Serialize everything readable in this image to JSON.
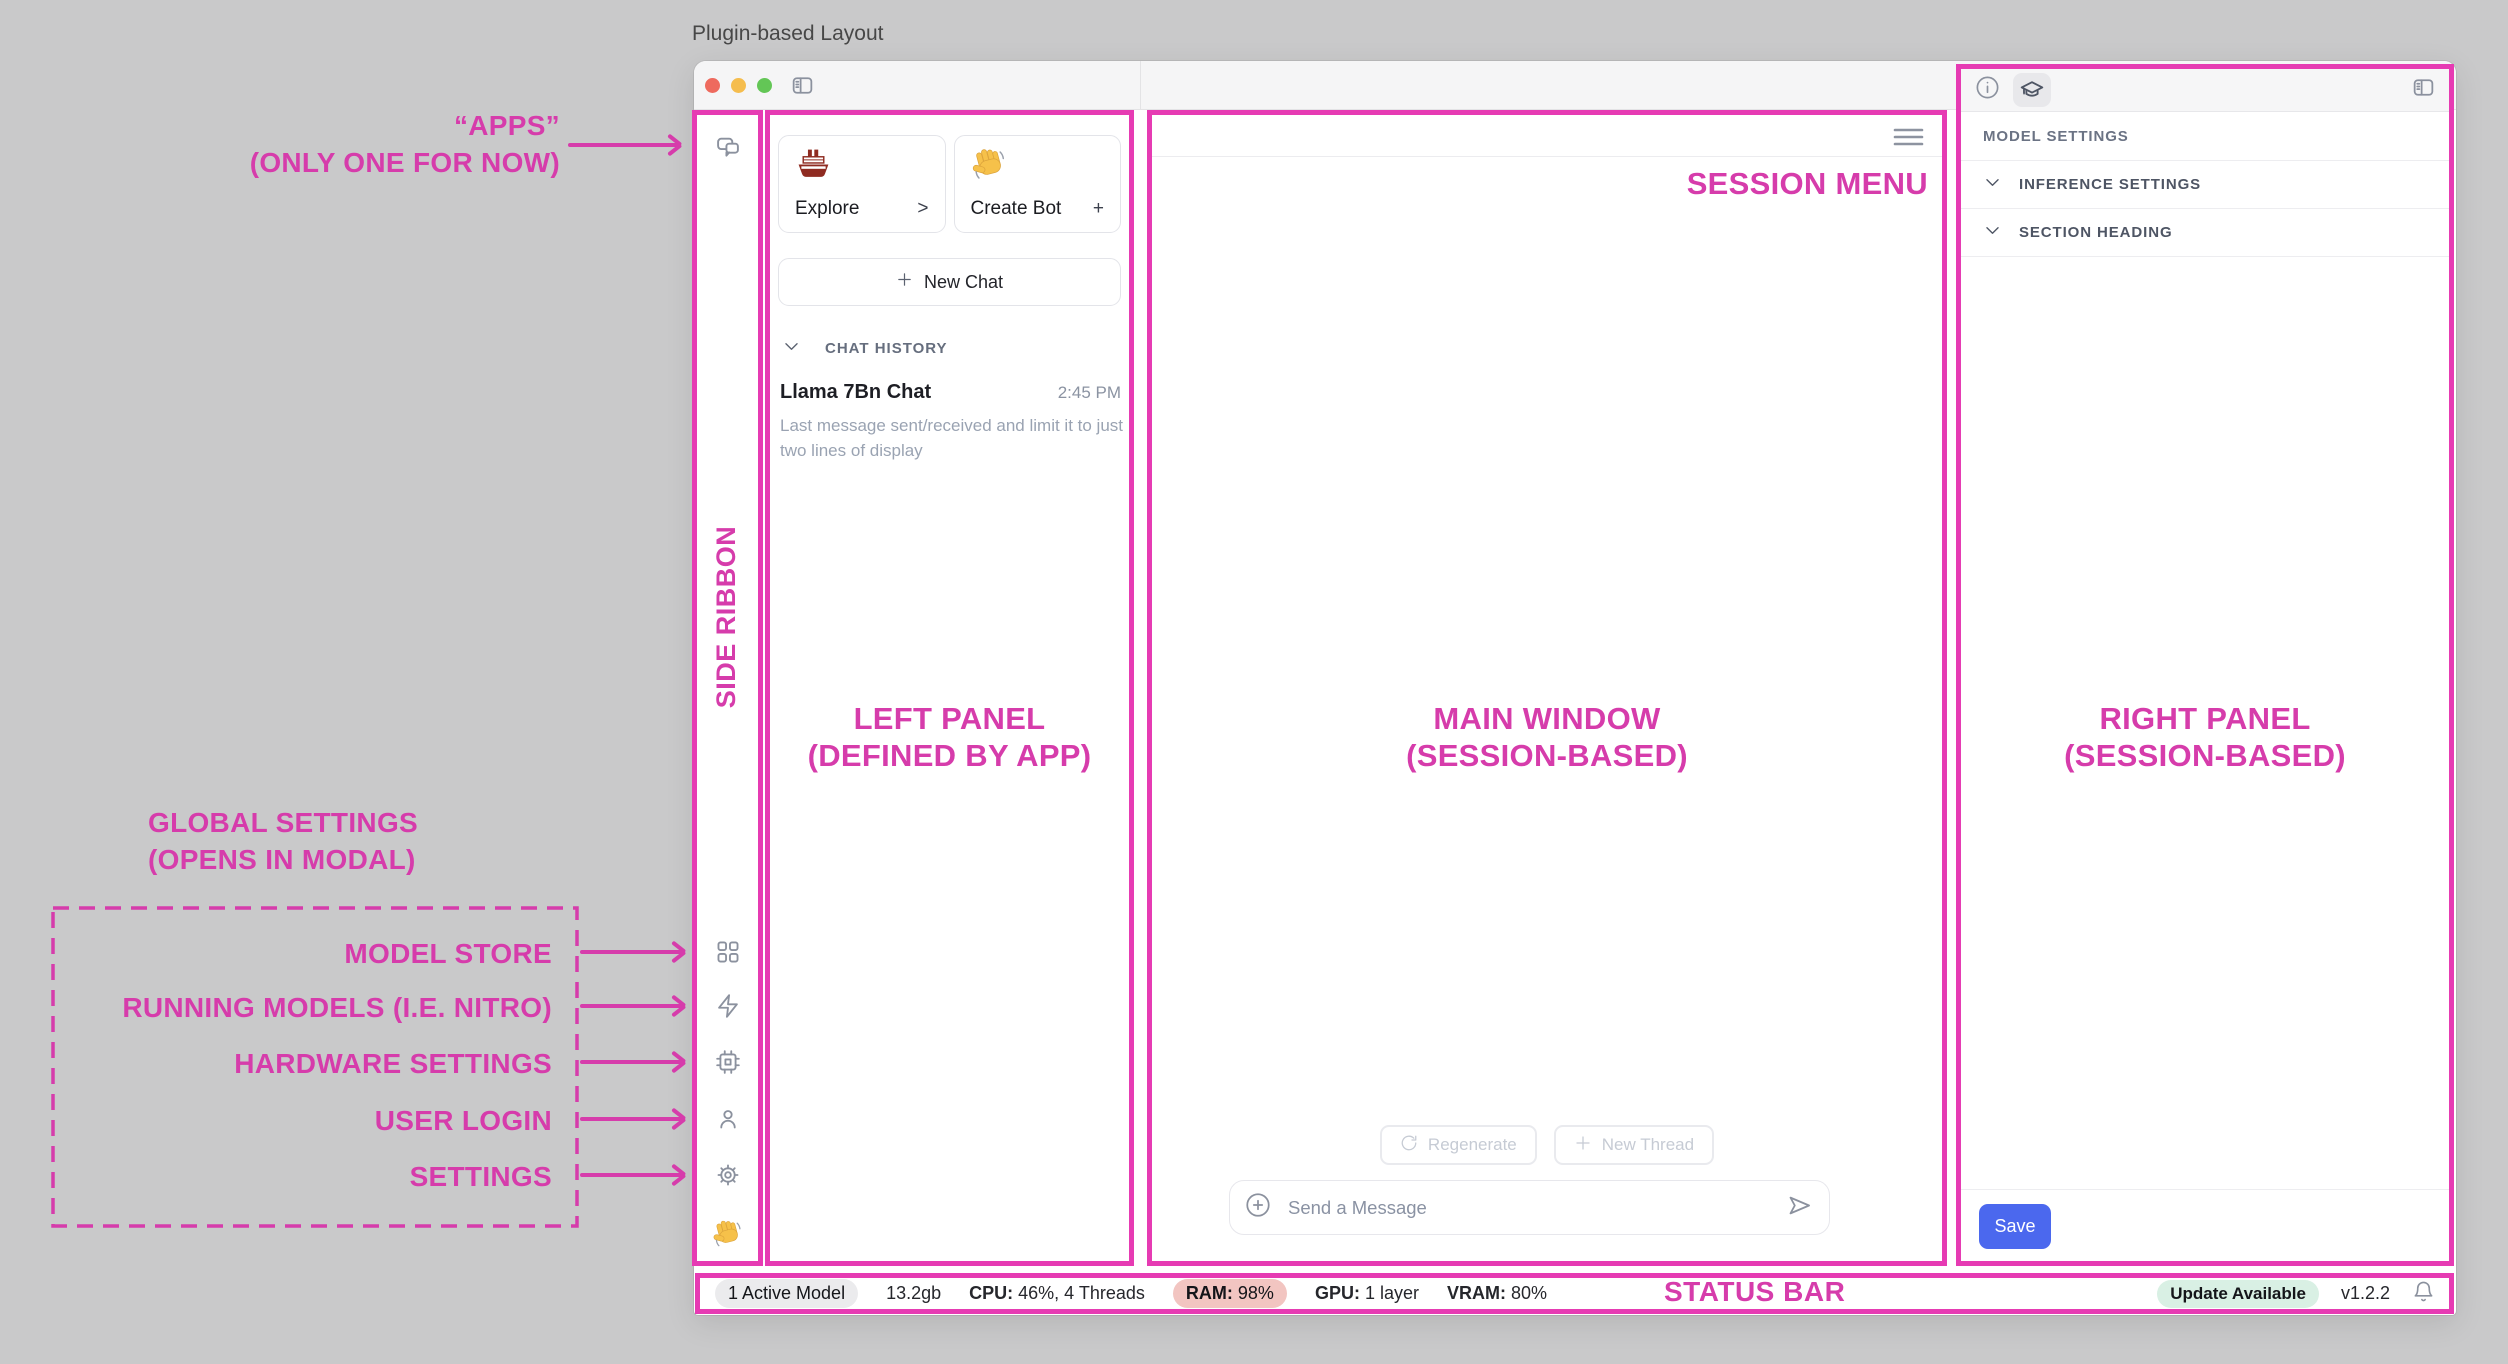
{
  "page": {
    "title": "Plugin-based Layout"
  },
  "annotations": {
    "apps_line1": "“APPS”",
    "apps_line2": "(ONLY ONE FOR NOW)",
    "side_ribbon": "SIDE RIBBON",
    "left_panel_line1": "LEFT PANEL",
    "left_panel_line2": "(DEFINED BY APP)",
    "main_window_line1": "MAIN WINDOW",
    "main_window_line2": "(SESSION-BASED)",
    "right_panel_line1": "RIGHT PANEL",
    "right_panel_line2": "(SESSION-BASED)",
    "session_menu": "SESSION MENU",
    "status_bar": "STATUS BAR",
    "global_settings_line1": "GLOBAL SETTINGS",
    "global_settings_line2": "(OPENS IN MODAL)",
    "ribbon_items": [
      "MODEL STORE",
      "RUNNING MODELS (I.E. NITRO)",
      "HARDWARE SETTINGS",
      "USER LOGIN",
      "SETTINGS"
    ]
  },
  "left_panel": {
    "explore_card": {
      "icon": "ship-emoji",
      "label": "Explore",
      "chevron": ">"
    },
    "create_bot_card": {
      "icon": "wave-emoji",
      "label": "Create Bot",
      "plus": "+"
    },
    "new_chat_label": "New Chat",
    "chat_history_header": "CHAT HISTORY",
    "chat": {
      "title": "Llama 7Bn Chat",
      "time": "2:45 PM",
      "preview": "Last message sent/received and limit it to just two lines of display"
    }
  },
  "main_window": {
    "regenerate_label": "Regenerate",
    "new_thread_label": "New Thread",
    "composer_placeholder": "Send a Message"
  },
  "right_panel": {
    "model_settings_label": "MODEL SETTINGS",
    "sections": [
      "INFERENCE SETTINGS",
      "SECTION HEADING"
    ],
    "save_label": "Save"
  },
  "status_bar": {
    "active_model": "1 Active Model",
    "memory": "13.2gb",
    "cpu_label": "CPU:",
    "cpu_value": "46%, 4 Threads",
    "ram_label": "RAM:",
    "ram_value": "98%",
    "gpu_label": "GPU:",
    "gpu_value": "1 layer",
    "vram_label": "VRAM:",
    "vram_value": "80%",
    "update_badge": "Update Available",
    "version": "v1.2.2"
  },
  "colors": {
    "annotation_pink": "#d63cab",
    "border_pink": "#e63bb3",
    "save_button_blue": "#4b68ee",
    "ram_pill_bg": "#f2c5c1",
    "update_pill_bg": "#d9f0e4",
    "traffic_red": "#ee6a5e",
    "traffic_yellow": "#f5bd4e",
    "traffic_green": "#63c656"
  },
  "icons": [
    "chat-bubbles-icon",
    "grid-icon",
    "lightning-icon",
    "cpu-chip-icon",
    "user-icon",
    "gear-icon",
    "wave-emoji",
    "ship-emoji",
    "sidebar-toggle-icon",
    "panel-toggle-icon",
    "info-icon",
    "graduation-cap-icon",
    "menu-icon",
    "refresh-icon",
    "plus-icon",
    "circle-plus-icon",
    "send-icon",
    "bell-icon",
    "chevron-down-icon"
  ]
}
